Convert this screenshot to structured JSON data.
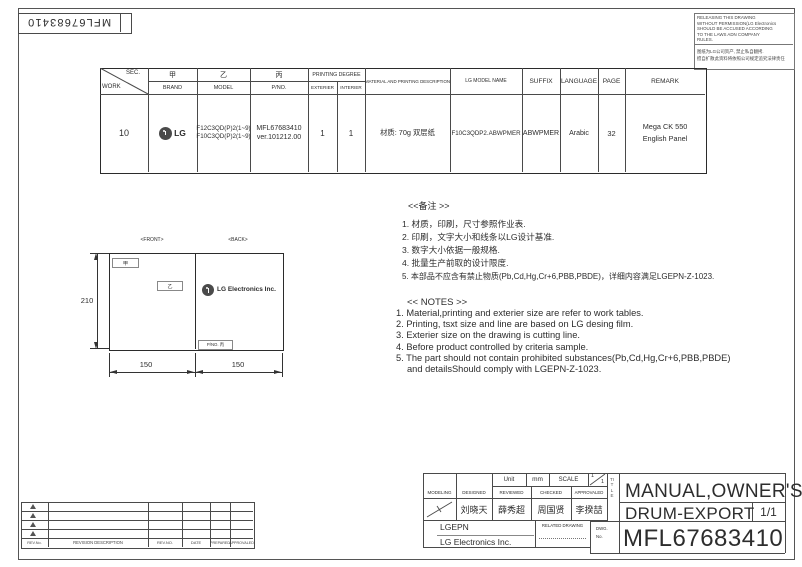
{
  "sheet": {
    "corner_pno": "MFL67683410",
    "notice_en": [
      "RELEASING THIS DRAWING",
      "WITHOUT PERMISSION(LG Electronics",
      "SHOULD BE ACCUSED ACCORDING",
      "TO THE LAWS ADN COMPANY",
      "RULES."
    ],
    "notice_cn": [
      "图纸为LG公司资产, 禁止私自翻拷.",
      "擅自扩散此资料将依照公司规定追究法律责任"
    ]
  },
  "table": {
    "header": {
      "sec": "SEC.",
      "work": "WORK",
      "jia": "甲",
      "brand": "BRAND",
      "yi": "乙",
      "model": "MODEL",
      "bing": "丙",
      "pno": "P/NO.",
      "printing_degree": "PRINTING DEGREE",
      "exterier": "EXTERIER",
      "interier": "INTERIER",
      "material": "MATERIAL AND PRINTING DESCRIPTION",
      "lg_model_name": "LG MODEL NAME",
      "suffix": "SUFFIX",
      "language": "LANGUAGE",
      "page": "PAGE",
      "remark": "REMARK"
    },
    "row": {
      "work": "10",
      "brand": "LG",
      "model1": "F12C3QD(P)2(1~9)",
      "model2": "F10C3QD(P)2(1~9)",
      "pno1": "MFL67683410",
      "pno2": "ver.101212.00",
      "exterier": "1",
      "interier": "1",
      "material": "材质: 70g 双层纸",
      "lg_model_name": "F10C3QDP2.ABWPMER",
      "suffix": "ABWPMER",
      "language": "Arabic",
      "page": "32",
      "remark1": "Mega CK 550",
      "remark2": "English Panel"
    }
  },
  "drawing": {
    "front_label": "<FRONT>",
    "back_label": "<BACK>",
    "jia": "甲",
    "yi": "乙",
    "back_brand": "LG Electronics Inc.",
    "pno_label": "P/NO. 丙",
    "dim_height": "210",
    "dim_left": "150",
    "dim_right": "150"
  },
  "notes_cn": {
    "heading": "<<备注 >>",
    "items": [
      "1.  材质，印刷，尺寸参照作业表.",
      "2.  印刷，文字大小和线条以LG设计基准.",
      "3.  数字大小依据一般规格.",
      "4.  批量生产前取的设计限度.",
      "5.  本部品不应含有禁止物质(Pb,Cd,Hg,Cr+6,PBB,PBDE)，详细内容满足LGEPN-Z-1023."
    ]
  },
  "notes_en": {
    "heading": "<< NOTES >>",
    "items": [
      "1. Material,printing and exterier size are refer to work tables.",
      "2. Printing, tsxt  size and line are based on LG desing film.",
      "3. Exterier size on the drawing is cutting line.",
      "4. Before product controlled by criteria sample.",
      "5. The part should not contain prohibited substances(Pb,Cd,Hg,Cr+6,PBB,PBDE)"
    ],
    "item5_cont": "and detailsShould comply with LGEPN-Z-1023."
  },
  "titleblock": {
    "unit_label": "Unit",
    "unit_value": "mm",
    "scale_label": "SCALE",
    "scale_top": "1",
    "scale_bottom": "1",
    "modeling": "MODELING",
    "designed": "DESIGNED",
    "reviewed": "REVIEWED",
    "checked": "CHECKED",
    "approvaled": "APPROVALED",
    "designed_name": "刘晓天",
    "reviewed_name": "薛秀超",
    "checked_name": "周国贤",
    "approvaled_name": "李揆喆",
    "company_short": "LGEPN",
    "company_full": "LG Electronics Inc.",
    "related_drawing": "RELATED DRAWING",
    "dwg_label_1": "DWG.",
    "dwg_label_2": "No.",
    "title_vertical": "TITLE",
    "title_line1": "MANUAL,OWNER'S",
    "title_line2": "DRUM-EXPORT",
    "sheet_count": "1/1",
    "dwg_no": "MFL67683410"
  },
  "revision": {
    "rev_no": "REV.No.",
    "description": "REVISION DESCRIPTION",
    "rev_no2": "REV.NO.",
    "date": "DATE",
    "prepared": "PREPARED",
    "approvaled": "APPROVALED"
  }
}
